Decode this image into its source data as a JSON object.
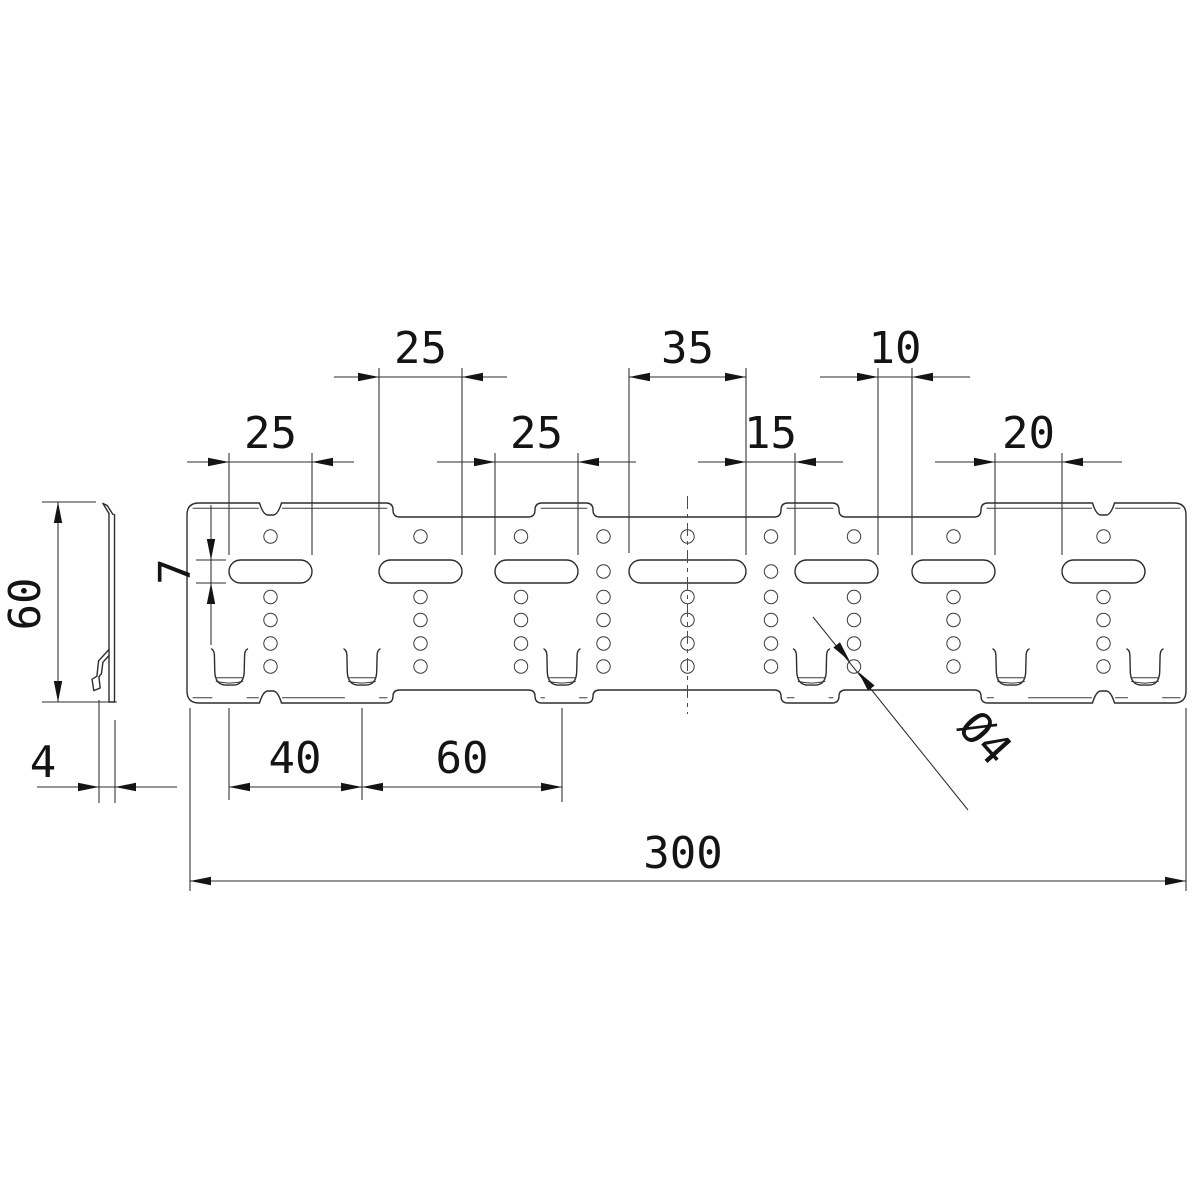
{
  "colors": {
    "background": "#ffffff",
    "line": "#2d2d2d",
    "text": "#141414"
  },
  "drawing": {
    "type": "technical-dimension-drawing",
    "front_view": {
      "left": 187,
      "right": 1186,
      "top": 503,
      "bottom": 703,
      "top_recessed": 517,
      "bottom_recessed": 690,
      "corner_r": 12,
      "step_flare": 7,
      "raised_sections": [
        [
          187,
          393
        ],
        [
          535,
          593
        ],
        [
          781,
          839
        ],
        [
          981,
          1186
        ]
      ],
      "edge_notches": [
        270.5,
        1103.5
      ],
      "slots": {
        "y": 560,
        "h": 23,
        "x_ranges": [
          [
            229,
            312
          ],
          [
            379,
            462
          ],
          [
            495,
            578
          ],
          [
            629,
            746
          ],
          [
            795,
            878
          ],
          [
            912,
            995
          ],
          [
            1062,
            1145
          ]
        ]
      },
      "tabs": {
        "centers": [
          229.5,
          362,
          562,
          811.5,
          1011,
          1145
        ]
      },
      "holes": {
        "r": 6.7,
        "cols": [
          270.5,
          420.5,
          521,
          603.5,
          687.5,
          771,
          854,
          953.5,
          1103.5
        ],
        "top_row_y": 536.5,
        "below_rows_y": [
          597,
          620,
          643.5,
          666.5
        ],
        "slot_row_y": 571.5,
        "slot_row_cols": [
          603.5,
          771
        ]
      },
      "centerline": {
        "x": 687.5,
        "y1": 496,
        "y2": 714
      },
      "secondary_top_y": 508.3,
      "secondary_bottom_y": 697.8
    },
    "side_view": {
      "strip": {
        "x1": 109,
        "x2": 114.5,
        "y_top": 513,
        "y_bottom": 702
      },
      "lines": [
        [
          109,
          513.5,
          109,
          702
        ],
        [
          114.5,
          514.5,
          114.5,
          702
        ],
        [
          109,
          702,
          114.5,
          702
        ],
        [
          103,
          503.5,
          109,
          513.5
        ],
        [
          107.2,
          505.5,
          113,
          514.5
        ],
        [
          103,
          503.5,
          107.2,
          505.5
        ]
      ],
      "hook_paths": [
        "M109 649.5 L98.6 660.8 L96.9 676.2 L92 679.2 L93.8 690.6 L100.2 688 L98.9 676.8",
        "M109 655.5 L102.9 662.3 L101.4 673.8 L98.9 676.8"
      ]
    },
    "dimensions": [
      {
        "id": "slot2-length",
        "label": "25",
        "value": 25,
        "axis": "h",
        "x1": 379,
        "x2": 462,
        "y": 377,
        "arrows": "out",
        "tails": 45,
        "ext": [
          [
            379,
            368,
            555
          ],
          [
            462,
            368,
            555
          ]
        ],
        "text": {
          "x": 420.5,
          "y": 363
        }
      },
      {
        "id": "center-slot-length",
        "label": "35",
        "value": 35,
        "axis": "h",
        "x1": 629,
        "x2": 746,
        "y": 377,
        "arrows": "in",
        "ext": [
          [
            629,
            368,
            553
          ],
          [
            746,
            368,
            555
          ]
        ],
        "text": {
          "x": 687.5,
          "y": 363
        }
      },
      {
        "id": "slot-gap-10",
        "label": "10",
        "value": 10,
        "axis": "h",
        "x1": 878,
        "x2": 912,
        "y": 377,
        "arrows": "out",
        "tails": 58,
        "ext": [
          [
            878,
            368,
            555
          ],
          [
            912,
            368,
            555
          ]
        ],
        "text": {
          "x": 895,
          "y": 363
        }
      },
      {
        "id": "slot1-length",
        "label": "25",
        "value": 25,
        "axis": "h",
        "x1": 229,
        "x2": 312,
        "y": 462,
        "arrows": "out",
        "tails": 42,
        "ext": [
          [
            229,
            453,
            555
          ],
          [
            312,
            453,
            555
          ]
        ],
        "text": {
          "x": 270.5,
          "y": 448
        }
      },
      {
        "id": "slot3-length",
        "label": "25",
        "value": 25,
        "axis": "h",
        "x1": 495,
        "x2": 578,
        "y": 462,
        "arrows": "out",
        "tails": 58,
        "ext": [
          [
            495,
            453,
            555
          ],
          [
            578,
            453,
            555
          ]
        ],
        "text": {
          "x": 536.5,
          "y": 448
        }
      },
      {
        "id": "slot-gap-15",
        "label": "15",
        "value": 15,
        "axis": "h",
        "x1": 746,
        "x2": 795,
        "y": 462,
        "arrows": "out",
        "tails": 48,
        "ext": [
          [
            795,
            453,
            555
          ]
        ],
        "text": {
          "x": 770.5,
          "y": 448
        }
      },
      {
        "id": "slot-gap-20",
        "label": "20",
        "value": 20,
        "axis": "h",
        "x1": 995,
        "x2": 1062,
        "y": 462,
        "arrows": "out",
        "tails": 60,
        "ext": [
          [
            995,
            453,
            555
          ],
          [
            1062,
            453,
            555
          ]
        ],
        "text": {
          "x": 1028.5,
          "y": 448
        }
      },
      {
        "id": "tab-spacing-40",
        "label": "40",
        "value": 40,
        "axis": "h",
        "x1": 229,
        "x2": 362,
        "y": 787,
        "arrows": "in",
        "ext": [
          [
            229,
            708,
            800
          ],
          [
            362,
            708,
            800
          ]
        ],
        "text": {
          "x": 295,
          "y": 773
        }
      },
      {
        "id": "tab-spacing-60",
        "label": "60",
        "value": 60,
        "axis": "h",
        "x1": 362,
        "x2": 562,
        "y": 787,
        "arrows": "in",
        "ext": [
          [
            562,
            708,
            802
          ]
        ],
        "text": {
          "x": 462,
          "y": 773
        }
      },
      {
        "id": "overall-length",
        "label": "300",
        "value": 300,
        "axis": "h",
        "x1": 190,
        "x2": 1186,
        "y": 881,
        "arrows": "in",
        "ext": [
          [
            190,
            708,
            891
          ],
          [
            1186,
            708,
            891
          ]
        ],
        "text": {
          "x": 683,
          "y": 868
        }
      },
      {
        "id": "overall-height",
        "label": "60",
        "value": 60,
        "axis": "v",
        "x": 58,
        "y1": 502,
        "y2": 702,
        "arrows": "in",
        "ext_h": [
          [
            42,
            96,
            502
          ],
          [
            42,
            117,
            702
          ]
        ],
        "text": {
          "x": 40,
          "y": 604,
          "rotate": -90
        }
      },
      {
        "id": "thickness",
        "label": "4",
        "value": 4,
        "axis": "h",
        "x1": 99,
        "x2": 115,
        "y": 787,
        "arrows": "out",
        "tails": 62,
        "ext": [
          [
            99,
            700,
            803
          ],
          [
            115,
            720,
            803
          ]
        ],
        "text": {
          "x": 43,
          "y": 777
        }
      },
      {
        "id": "slot-height",
        "label": "7",
        "value": 7,
        "axis": "v",
        "x": 211,
        "y1": 560,
        "y2": 583,
        "arrows": "out",
        "tails": 24,
        "vline": [
          505,
          645
        ],
        "ext_h": [
          [
            196,
            226,
            560
          ],
          [
            196,
            226,
            583
          ]
        ],
        "text": {
          "x": 190,
          "y": 571.5,
          "rotate": -90
        }
      }
    ],
    "leader_dimension": {
      "id": "hole-diameter",
      "label": "Ø4",
      "value": 4,
      "line": [
        813,
        617,
        968,
        810
      ],
      "hole": {
        "cx": 854,
        "cy": 666.5,
        "r": 6.7
      },
      "text": {
        "x": 974,
        "y": 748,
        "rotate": 48
      }
    }
  }
}
